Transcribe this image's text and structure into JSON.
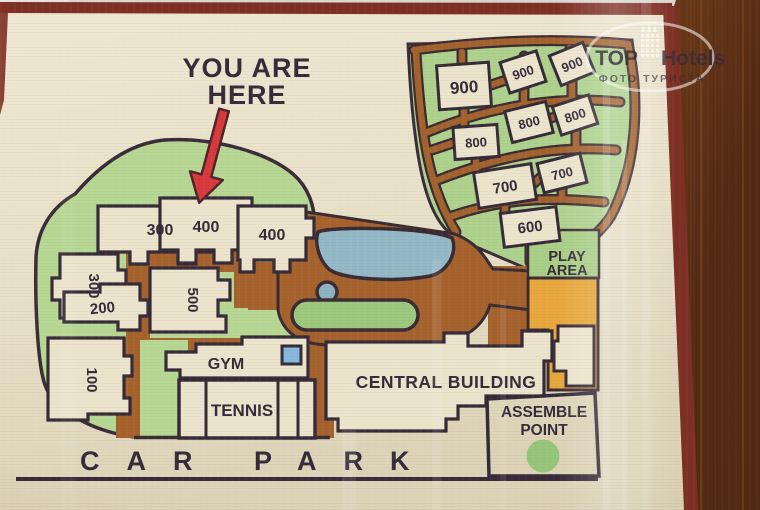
{
  "photo": {
    "description": "photograph of a printed resort site map lying on a dark wooden table",
    "watermark": {
      "brand_left": "TOP",
      "brand_right": "Hotels",
      "subtitle": "ФОТО ТУРИСТА",
      "icon": "hotel-tower-icon"
    }
  },
  "map": {
    "you_are_here": {
      "line1": "YOU ARE",
      "line2": "HERE"
    },
    "buildings": {
      "b300_upper": "300",
      "b300_lower": "300",
      "b400_left": "400",
      "b400_right": "400",
      "b500": "500",
      "b200": "200",
      "b100": "100",
      "b900_main": "900",
      "b900_mid": "900",
      "b900_right": "900",
      "b800_left": "800",
      "b800_mid": "800",
      "b800_right": "800",
      "b700_left": "700",
      "b700_right": "700",
      "b600": "600"
    },
    "facilities": {
      "gym": "GYM",
      "tennis": "TENNIS",
      "central_building": "CENTRAL BUILDING",
      "assemble_line1": "ASSEMBLE",
      "assemble_line2": "POINT",
      "play_line1": "PLAY",
      "play_line2": "AREA",
      "car_park": "CAR PARK"
    },
    "colors": {
      "lawn_green": "#b7d794",
      "fan_green": "#aed28d",
      "road_brown": "#a5622d",
      "water_blue": "#93b9c8",
      "activity_orange": "#e7a73c",
      "outline_dark": "#3a2b38",
      "paper_cream": "#eae2cb",
      "marker_red": "#d8393c",
      "frame_maroon": "#7e2f24",
      "wood_brown": "#7b431f",
      "assemble_dot_green": "#8fc474"
    }
  }
}
